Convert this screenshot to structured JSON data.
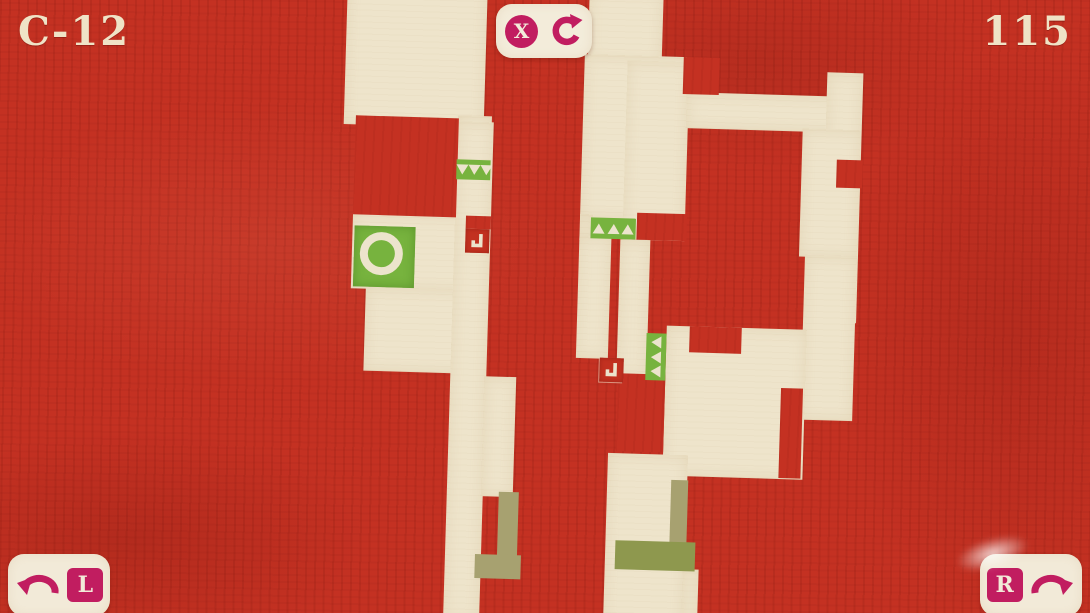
{
  "hud": {
    "level": "C-12",
    "counter": "115",
    "undo_label": "X",
    "rotate_left_label": "L",
    "rotate_right_label": "R"
  },
  "colors": {
    "background_red": "#c43122",
    "tile_cream": "#eee4cb",
    "panel_cream": "#f2ead8",
    "accent_magenta": "#c11d60",
    "player_green": "#77b33e",
    "olive_light": "#a7a170",
    "olive_dark": "#8e984e"
  },
  "icons": {
    "top_center": [
      "x-undo-icon",
      "rotate-restart-icon"
    ],
    "bottom_left": "rotate-counterclockwise-arrow-icon",
    "bottom_right": "rotate-clockwise-arrow-icon"
  },
  "board": {
    "cream_tiles": [
      [
        338,
        -12,
        140,
        142
      ],
      [
        452,
        118,
        34,
        122
      ],
      [
        350,
        218,
        136,
        76
      ],
      [
        365,
        292,
        122,
        84
      ],
      [
        452,
        124,
        36,
        500
      ],
      [
        486,
        378,
        32,
        120
      ],
      [
        580,
        -12,
        74,
        72
      ],
      [
        577,
        53,
        102,
        164
      ],
      [
        577,
        213,
        13,
        26
      ],
      [
        577,
        235,
        32,
        122
      ],
      [
        618,
        237,
        30,
        138
      ],
      [
        620,
        58,
        62,
        179
      ],
      [
        680,
        88,
        174,
        36
      ],
      [
        820,
        64,
        36,
        250
      ],
      [
        797,
        121,
        58,
        128
      ],
      [
        803,
        247,
        52,
        165
      ],
      [
        667,
        322,
        140,
        150
      ],
      [
        612,
        451,
        80,
        172
      ],
      [
        690,
        565,
        16,
        58
      ]
    ],
    "red_patches": [
      [
        350,
        121,
        103,
        99
      ],
      [
        463,
        218,
        25,
        13
      ],
      [
        690,
        322,
        52,
        26
      ],
      [
        783,
        381,
        22,
        90
      ],
      [
        832,
        151,
        26,
        28
      ],
      [
        620,
        371,
        47,
        78
      ],
      [
        634,
        210,
        50,
        27
      ],
      [
        676,
        53,
        36,
        37
      ]
    ],
    "olive_pieces": [
      [
        504,
        493,
        20,
        65,
        "light"
      ],
      [
        482,
        556,
        46,
        24,
        "light"
      ],
      [
        676,
        476,
        17,
        64,
        "light"
      ],
      [
        622,
        538,
        80,
        29,
        "dark"
      ]
    ],
    "triangle_bands": [
      {
        "x": 452,
        "y": 162,
        "w": 34,
        "h": 20,
        "dir": "down",
        "count": 3
      },
      {
        "x": 588,
        "y": 216,
        "w": 45,
        "h": 21,
        "dir": "up",
        "count": 3
      },
      {
        "x": 647,
        "y": 330,
        "w": 20,
        "h": 47,
        "dir": "left",
        "count": 3
      }
    ],
    "rotation_anchors": [
      {
        "x": 463,
        "y": 231
      },
      {
        "x": 601,
        "y": 356
      }
    ],
    "player": {
      "x": 352,
      "y": 231,
      "size": 61
    }
  }
}
